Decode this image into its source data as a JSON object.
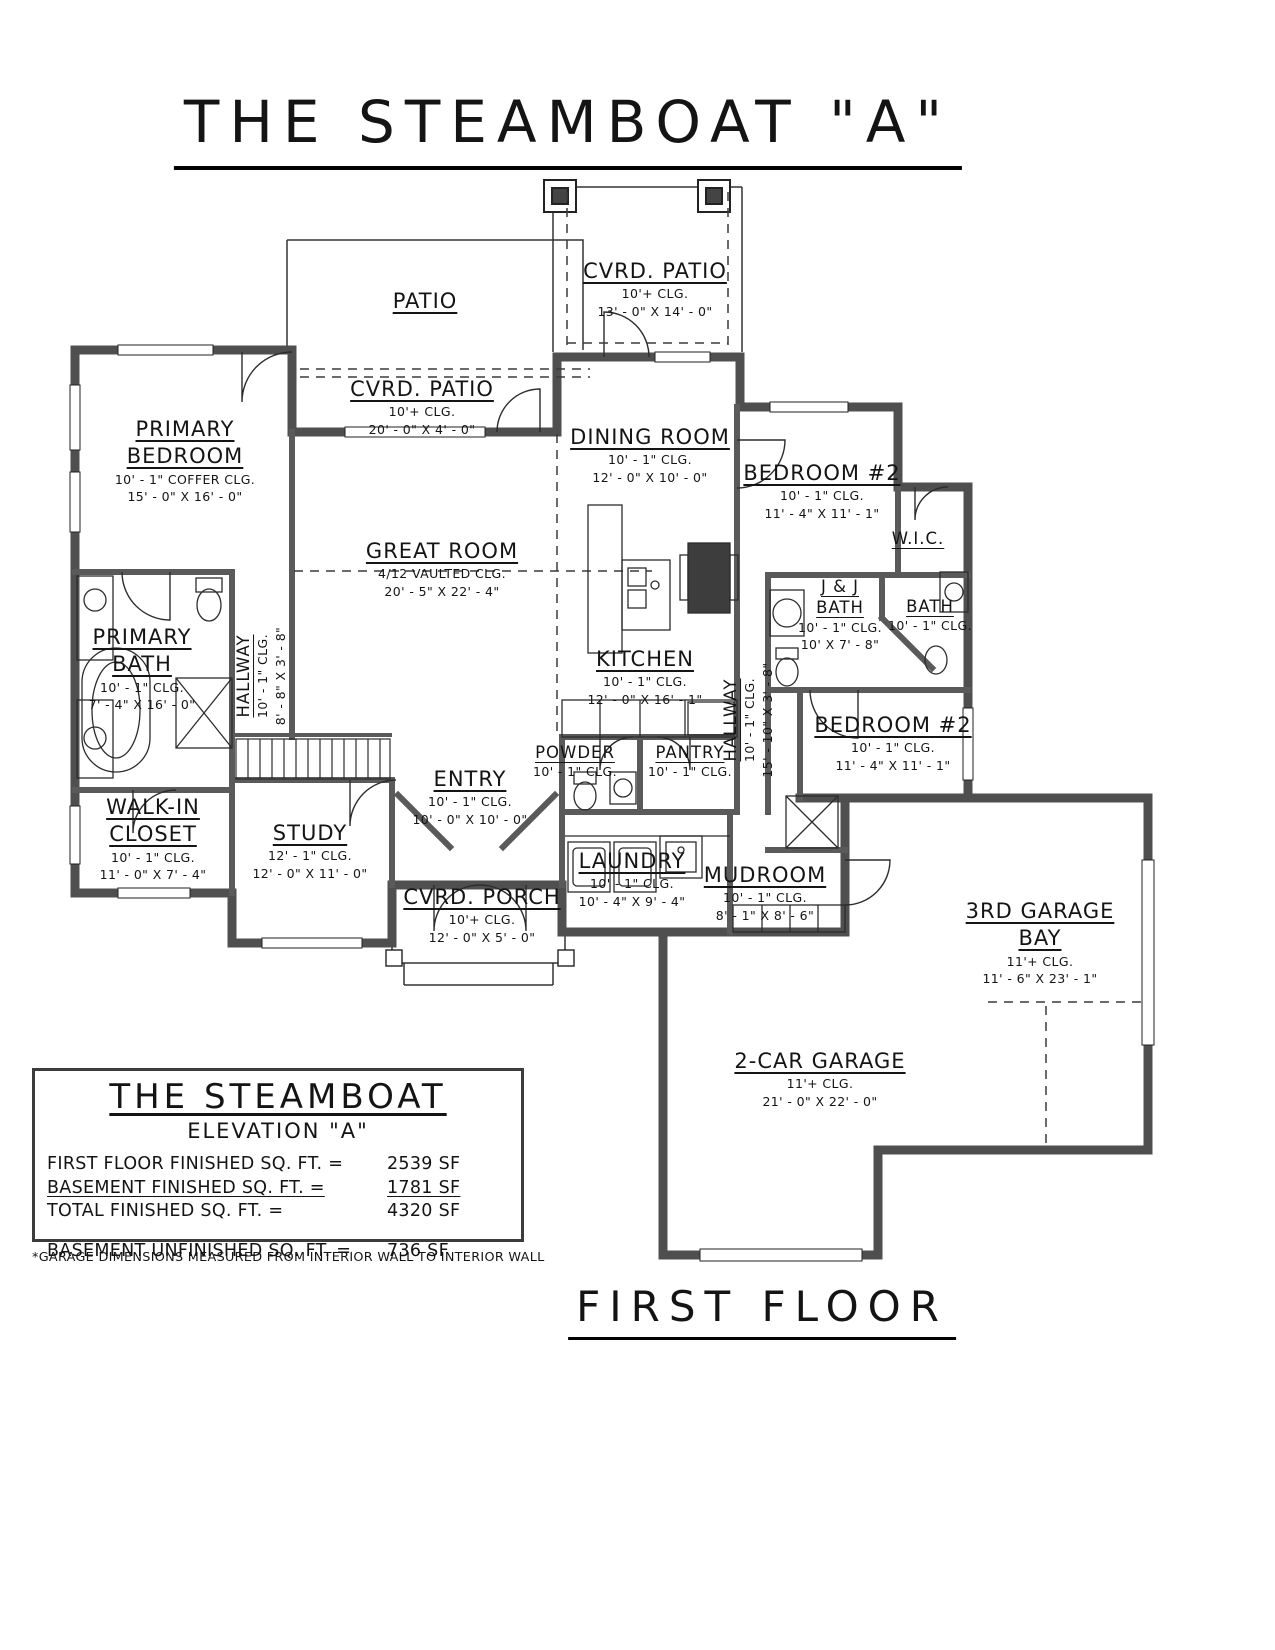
{
  "title": "THE STEAMBOAT \"A\"",
  "footer": {
    "label": "FIRST FLOOR"
  },
  "note": "*GARAGE DIMENSIONS MEASURED FROM INTERIOR WALL TO INTERIOR WALL",
  "info_box": {
    "title": "THE STEAMBOAT",
    "subtitle": "ELEVATION \"A\"",
    "rows": [
      {
        "label": "FIRST FLOOR FINISHED SQ. FT. =",
        "value": "2539 SF"
      },
      {
        "label": "BASEMENT FINISHED SQ. FT. =",
        "value": "1781 SF"
      },
      {
        "label": "TOTAL FINISHED SQ. FT. =",
        "value": "4320 SF"
      },
      {
        "label": "BASEMENT UNFINISHED SQ. FT. =",
        "value": "736 SF"
      }
    ]
  },
  "rooms": [
    {
      "name": "CVRD. PATIO",
      "clg": "10'+ CLG.",
      "dims": "13' - 0\" X 14' - 0\""
    },
    {
      "name": "PATIO"
    },
    {
      "name": "CVRD. PATIO",
      "clg": "10'+ CLG.",
      "dims": "20' - 0\" X 4' - 0\""
    },
    {
      "name": "PRIMARY\nBEDROOM",
      "clg": "10' - 1\" COFFER CLG.",
      "dims": "15' - 0\" X 16' - 0\""
    },
    {
      "name": "DINING ROOM",
      "clg": "10' - 1\" CLG.",
      "dims": "12' - 0\" X 10' - 0\""
    },
    {
      "name": "BEDROOM #2",
      "clg": "10' - 1\" CLG.",
      "dims": "11' - 4\" X 11' - 1\""
    },
    {
      "name": "GREAT ROOM",
      "clg": "4/12 VAULTED CLG.",
      "dims": "20' - 5\" X 22' - 4\""
    },
    {
      "name": "W.I.C."
    },
    {
      "name": "PRIMARY\nBATH",
      "clg": "10' - 1\" CLG.",
      "dims": "7' - 4\" X 16' - 0\""
    },
    {
      "name": "HALLWAY",
      "clg": "10' - 1\" CLG.",
      "dims": "8' - 8\" X 3' - 8\""
    },
    {
      "name": "J & J\nBATH",
      "clg": "10' - 1\" CLG.",
      "dims": "10' X 7' - 8\""
    },
    {
      "name": "BATH",
      "clg": "10' - 1\" CLG."
    },
    {
      "name": "KITCHEN",
      "clg": "10' - 1\" CLG.",
      "dims": "12' - 0\" X 16' - 1\""
    },
    {
      "name": "HALLWAY",
      "clg": "10' - 1\" CLG.",
      "dims": "15' - 10\" X 3' - 8\""
    },
    {
      "name": "BEDROOM #2",
      "clg": "10' - 1\" CLG.",
      "dims": "11' - 4\" X 11' - 1\""
    },
    {
      "name": "POWDER",
      "clg": "10' - 1\" CLG."
    },
    {
      "name": "PANTRY",
      "clg": "10' - 1\" CLG."
    },
    {
      "name": "ENTRY",
      "clg": "10' - 1\" CLG.",
      "dims": "10' - 0\" X 10' - 0\""
    },
    {
      "name": "WALK-IN\nCLOSET",
      "clg": "10' - 1\" CLG.",
      "dims": "11' - 0\" X 7' - 4\""
    },
    {
      "name": "STUDY",
      "clg": "12' - 1\" CLG.",
      "dims": "12' - 0\" X 11' - 0\""
    },
    {
      "name": "LAUNDRY",
      "clg": "10' - 1\" CLG.",
      "dims": "10' - 4\" X 9' - 4\""
    },
    {
      "name": "MUDROOM",
      "clg": "10' - 1\" CLG.",
      "dims": "8' - 1\" X 8' - 6\""
    },
    {
      "name": "CVRD. PORCH",
      "clg": "10'+ CLG.",
      "dims": "12' - 0\" X 5' - 0\""
    },
    {
      "name": "3RD GARAGE\nBAY",
      "clg": "11'+ CLG.",
      "dims": "11' - 6\" X 23' - 1\""
    },
    {
      "name": "2-CAR GARAGE",
      "clg": "11'+ CLG.",
      "dims": "21' - 0\" X 22' - 0\""
    }
  ]
}
